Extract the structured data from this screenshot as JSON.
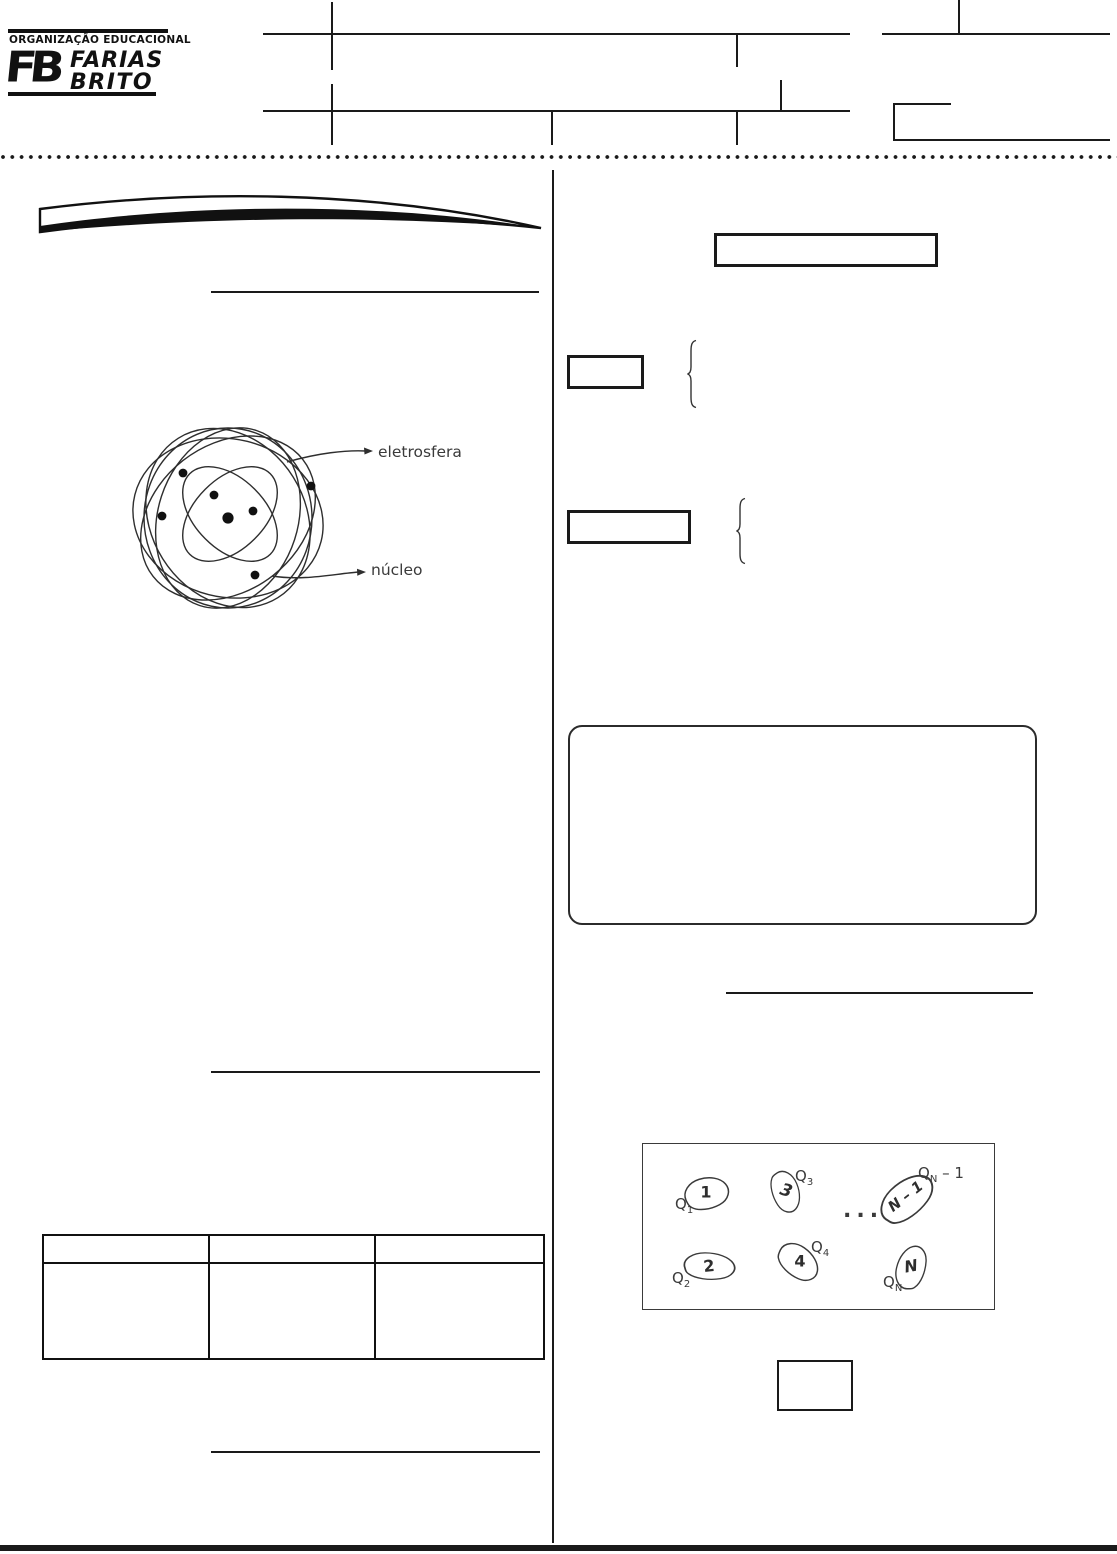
{
  "colors": {
    "ink": "#1a1a1a",
    "figure_ink": "#3a3a3a",
    "paper": "#ffffff"
  },
  "header": {
    "logo": {
      "org_label": "ORGANIZAÇÃO EDUCACIONAL",
      "monogram": "FB",
      "name_line1": "FARIAS",
      "name_line2": "BRITO"
    }
  },
  "atom_figure": {
    "label_electrosphere": "eletrosfera",
    "label_nucleus": "núcleo"
  },
  "charges_figure": {
    "ellipsis": "...",
    "q_prefix": "Q",
    "items": [
      {
        "number": "1",
        "sub": "1",
        "suffix": ""
      },
      {
        "number": "2",
        "sub": "2",
        "suffix": ""
      },
      {
        "number": "3",
        "sub": "3",
        "suffix": ""
      },
      {
        "number": "4",
        "sub": "4",
        "suffix": ""
      },
      {
        "number": "N – 1",
        "sub": "N",
        "suffix": " – 1"
      },
      {
        "number": "N",
        "sub": "N",
        "suffix": ""
      }
    ]
  },
  "table": {
    "columns": [
      "",
      "",
      ""
    ],
    "rows": [
      [
        "",
        "",
        ""
      ]
    ]
  }
}
